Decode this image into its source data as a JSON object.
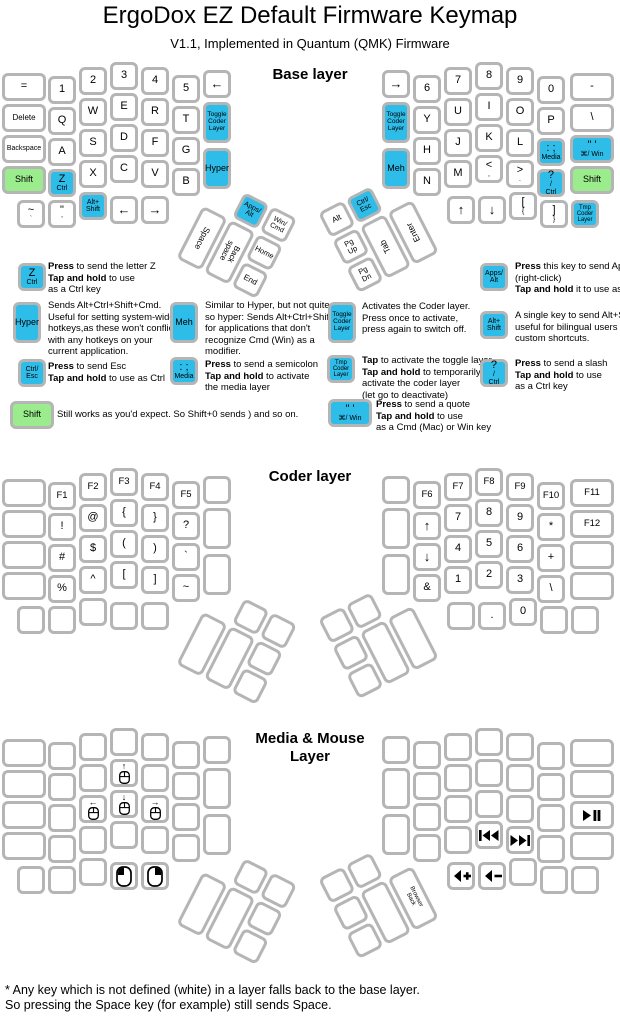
{
  "title": "ErgoDox EZ Default Firmware Keymap",
  "subtitle": "V1.1, Implemented in Quantum (QMK) Firmware",
  "colors": {
    "key_blue": "#2ebce9",
    "key_green": "#9aec8c",
    "key_border": "#b5b5b5"
  },
  "footer": {
    "line1": "* Any key which is not defined (white) in a layer falls back to the base layer.",
    "line2": "So pressing the Space key (for example) still sends Space."
  },
  "layers": [
    {
      "title": "Base layer",
      "dy": 0,
      "title_top": 66,
      "keys": [
        "=",
        "1",
        "2",
        "3",
        "4",
        "5",
        {
          "l": [
            "←"
          ],
          "fs": 13
        },
        {
          "l": [
            "Delete"
          ],
          "fs": 8
        },
        "Q",
        "W",
        "E",
        "R",
        "T",
        {
          "l": [
            "Toggle",
            "Coder",
            "Layer"
          ],
          "c": "b",
          "fs": 6.5
        },
        {
          "l": [
            "Backspace"
          ],
          "fs": 7
        },
        "A",
        "S",
        "D",
        "F",
        "G",
        {
          "l": [
            "Hyper"
          ],
          "c": "b",
          "fs": 9
        },
        {
          "l": [
            "Shift"
          ],
          "c": "g",
          "fs": 9
        },
        {
          "l": [
            "Z",
            "Ctrl"
          ],
          "c": "b",
          "big": true
        },
        "X",
        "C",
        "V",
        "B",
        {
          "l": [
            "~",
            "`"
          ],
          "big": true
        },
        {
          "l": [
            "\"",
            "'"
          ],
          "big": true
        },
        {
          "l": [
            "Alt+",
            "Shift"
          ],
          "c": "b",
          "fs": 7
        },
        {
          "l": [
            "←"
          ],
          "fs": 13
        },
        {
          "l": [
            "→"
          ],
          "fs": 13
        },
        {
          "l": [
            "Apps/",
            "Alt"
          ],
          "c": "b",
          "fs": 7
        },
        {
          "l": [
            "Win/",
            "Cmd"
          ],
          "fs": 7
        },
        {
          "l": [
            "Space"
          ],
          "fs": 8.5,
          "tr": 90
        },
        {
          "l": [
            "Back",
            "space"
          ],
          "fs": 8,
          "tr": 90
        },
        {
          "l": [
            "Home"
          ],
          "fs": 7.5
        },
        {
          "l": [
            "End"
          ],
          "fs": 8
        },
        {
          "l": [
            "→"
          ],
          "fs": 13
        },
        "6",
        "7",
        "8",
        "9",
        "0",
        "-",
        {
          "l": [
            "Toggle",
            "Coder",
            "Layer"
          ],
          "c": "b",
          "fs": 6.5
        },
        "Y",
        "U",
        "I",
        "O",
        "P",
        "\\",
        {
          "l": [
            "Meh"
          ],
          "c": "b",
          "fs": 9
        },
        "H",
        "J",
        "K",
        "L",
        {
          "l": [
            ": ;",
            "Media"
          ],
          "c": "b",
          "big": true
        },
        {
          "l": [
            "\" '",
            "⌘/ Win"
          ],
          "c": "b",
          "big": true
        },
        "N",
        "M",
        {
          "l": [
            "<",
            ","
          ],
          "big": true
        },
        {
          "l": [
            ">",
            "."
          ],
          "big": true
        },
        {
          "l": [
            "?",
            "/",
            "Ctrl"
          ],
          "c": "b",
          "big": true
        },
        {
          "l": [
            "Shift"
          ],
          "c": "g",
          "fs": 9
        },
        {
          "l": [
            "↑"
          ],
          "fs": 13
        },
        {
          "l": [
            "↓"
          ],
          "fs": 13
        },
        {
          "l": [
            "[",
            "{"
          ],
          "big": true
        },
        {
          "l": [
            "]",
            "}"
          ],
          "big": true
        },
        {
          "l": [
            "Tmp",
            "Coder",
            "Layer"
          ],
          "c": "b",
          "fs": 6
        },
        {
          "l": [
            "Alt"
          ],
          "fs": 8
        },
        {
          "l": [
            "Ctrl/",
            "Esc"
          ],
          "c": "b",
          "fs": 7
        },
        {
          "l": [
            "Pg",
            "Up"
          ],
          "fs": 7.5
        },
        {
          "l": [
            "Pg",
            "Dn"
          ],
          "fs": 7.5
        },
        {
          "l": [
            "Tab"
          ],
          "fs": 8.5,
          "tr": -90
        },
        {
          "l": [
            "Enter"
          ],
          "fs": 8.5,
          "tr": -90
        }
      ]
    },
    {
      "title": "Coder layer",
      "dy": 406,
      "title_top": 468,
      "keys": [
        null,
        {
          "l": [
            "F1"
          ],
          "fs": 9.5
        },
        {
          "l": [
            "F2"
          ],
          "fs": 9.5
        },
        {
          "l": [
            "F3"
          ],
          "fs": 9.5
        },
        {
          "l": [
            "F4"
          ],
          "fs": 9.5
        },
        {
          "l": [
            "F5"
          ],
          "fs": 9.5
        },
        null,
        null,
        "!",
        "@",
        "{",
        "}",
        "?",
        null,
        null,
        "#",
        "$",
        "(",
        ")",
        "`",
        null,
        null,
        "%",
        "^",
        "[",
        "]",
        "~",
        null,
        null,
        null,
        null,
        null,
        null,
        null,
        null,
        null,
        null,
        null,
        null,
        {
          "l": [
            "F6"
          ],
          "fs": 9.5
        },
        {
          "l": [
            "F7"
          ],
          "fs": 9.5
        },
        {
          "l": [
            "F8"
          ],
          "fs": 9.5
        },
        {
          "l": [
            "F9"
          ],
          "fs": 9.5
        },
        {
          "l": [
            "F10"
          ],
          "fs": 9.5
        },
        {
          "l": [
            "F11"
          ],
          "fs": 9.5
        },
        null,
        {
          "l": [
            "↑"
          ],
          "fs": 13
        },
        "7",
        "8",
        "9",
        "*",
        {
          "l": [
            "F12"
          ],
          "fs": 9.5
        },
        null,
        {
          "l": [
            "↓"
          ],
          "fs": 13
        },
        "4",
        "5",
        "6",
        "+",
        null,
        "&",
        "1",
        "2",
        "3",
        "\\",
        null,
        null,
        ".",
        "0",
        null,
        null,
        null,
        null,
        null,
        null,
        null,
        null
      ]
    },
    {
      "title": "Media & Mouse\nLayer",
      "dy": 666,
      "title_top": 730,
      "keys": [
        null,
        null,
        null,
        null,
        null,
        null,
        null,
        null,
        null,
        null,
        {
          "ic": "mouse-up"
        },
        null,
        null,
        null,
        null,
        null,
        {
          "ic": "mouse-left"
        },
        {
          "ic": "mouse-down"
        },
        {
          "ic": "mouse-right"
        },
        null,
        null,
        null,
        null,
        null,
        null,
        null,
        null,
        null,
        null,
        null,
        {
          "ic": "left-click"
        },
        {
          "ic": "right-click"
        },
        null,
        null,
        null,
        null,
        null,
        null,
        null,
        null,
        null,
        null,
        null,
        null,
        null,
        null,
        null,
        null,
        null,
        null,
        null,
        null,
        null,
        null,
        null,
        null,
        null,
        null,
        {
          "ic": "play-pause"
        },
        null,
        null,
        {
          "ic": "prev-track"
        },
        {
          "ic": "next-track"
        },
        null,
        null,
        {
          "ic": "volume-up"
        },
        {
          "ic": "volume-down"
        },
        null,
        null,
        null,
        null,
        null,
        null,
        null,
        null,
        {
          "l": [
            "Browser",
            "Back"
          ],
          "fs": 6,
          "tr": 90
        }
      ]
    }
  ],
  "legend": [
    {
      "x": 18,
      "y": 263,
      "kw": 28,
      "kh": 28,
      "key": {
        "l": [
          "Z",
          "Ctrl"
        ],
        "c": "b",
        "big": true
      },
      "tx": 48,
      "ty": 261,
      "lines": [
        "**Press** to send the letter Z",
        "**Tap and hold** to use",
        "as a Ctrl key"
      ]
    },
    {
      "x": 13,
      "y": 302,
      "kw": 28,
      "kh": 41,
      "key": {
        "l": [
          "Hyper"
        ],
        "c": "b",
        "fs": 9
      },
      "tx": 48,
      "ty": 300,
      "lines": [
        "Sends Alt+Ctrl+Shift+Cmd.",
        "Useful for setting system-wide",
        "hotkeys,as these won't conflict",
        "with any hotkeys on your",
        "current application."
      ]
    },
    {
      "x": 18,
      "y": 359,
      "kw": 28,
      "kh": 28,
      "key": {
        "l": [
          "Ctrl/",
          "Esc"
        ],
        "c": "b",
        "fs": 7
      },
      "tx": 48,
      "ty": 361,
      "lines": [
        "**Press** to send Esc",
        "**Tap and hold** to use as Ctrl"
      ]
    },
    {
      "x": 10,
      "y": 401,
      "kw": 44,
      "kh": 28,
      "key": {
        "l": [
          "Shift"
        ],
        "c": "g",
        "fs": 9
      },
      "tx": 57,
      "ty": 409,
      "lines": [
        "Still works as you'd expect. So Shift+0 sends ) and so on."
      ]
    },
    {
      "x": 170,
      "y": 302,
      "kw": 28,
      "kh": 41,
      "key": {
        "l": [
          "Meh"
        ],
        "c": "b",
        "fs": 9
      },
      "tx": 205,
      "ty": 300,
      "lines": [
        "Similar to Hyper, but not quite",
        "so hyper: Sends Alt+Ctrl+Shift,",
        "for applications that don't",
        "recognize Cmd (Win) as a",
        "modifier."
      ]
    },
    {
      "x": 170,
      "y": 357,
      "kw": 28,
      "kh": 28,
      "key": {
        "l": [
          ": ;",
          "Media"
        ],
        "c": "b",
        "big": true
      },
      "tx": 205,
      "ty": 359,
      "lines": [
        "**Press** to send a semicolon",
        "**Tap and hold** to activate",
        "the media layer"
      ]
    },
    {
      "x": 328,
      "y": 302,
      "kw": 28,
      "kh": 41,
      "key": {
        "l": [
          "Toggle",
          "Coder",
          "Layer"
        ],
        "c": "b",
        "fs": 6.5
      },
      "tx": 362,
      "ty": 301,
      "lines": [
        "Activates the Coder layer.",
        "Press once to activate,",
        "press again to switch off."
      ]
    },
    {
      "x": 327,
      "y": 355,
      "kw": 28,
      "kh": 28,
      "key": {
        "l": [
          "Tmp",
          "Coder",
          "Layer"
        ],
        "c": "b",
        "fs": 6
      },
      "tx": 362,
      "ty": 355,
      "lines": [
        "**Tap** to activate the toggle layer.",
        "**Tap and hold** to temporarily",
        "activate the coder layer",
        "(let go to deactivate)"
      ]
    },
    {
      "x": 328,
      "y": 399,
      "kw": 44,
      "kh": 28,
      "key": {
        "l": [
          "\" '",
          "⌘/ Win"
        ],
        "c": "b",
        "big": true
      },
      "tx": 376,
      "ty": 399,
      "lines": [
        "**Press** to send a quote",
        "**Tap and hold** to use",
        "as a Cmd (Mac) or Win key"
      ]
    },
    {
      "x": 480,
      "y": 263,
      "kw": 28,
      "kh": 28,
      "key": {
        "l": [
          "Apps/",
          "Alt"
        ],
        "c": "b",
        "fs": 7
      },
      "tx": 515,
      "ty": 261,
      "lines": [
        "**Press** this key to send Apps",
        "(right-click)",
        "**Tap and hold** it to use as Alt"
      ]
    },
    {
      "x": 480,
      "y": 311,
      "kw": 28,
      "kh": 28,
      "key": {
        "l": [
          "Alt+",
          "Shift"
        ],
        "c": "b",
        "fs": 7
      },
      "tx": 515,
      "ty": 310,
      "lines": [
        "A single key to send Alt+Shift,",
        "useful for bilingual users and",
        "custom shortcuts."
      ]
    },
    {
      "x": 480,
      "y": 359,
      "kw": 28,
      "kh": 28,
      "key": {
        "l": [
          "?",
          "/",
          "Ctrl"
        ],
        "c": "b",
        "big": true
      },
      "tx": 515,
      "ty": 358,
      "lines": [
        "**Press** to send a slash",
        "**Tap and hold** to use",
        "as a Ctrl key"
      ]
    }
  ]
}
